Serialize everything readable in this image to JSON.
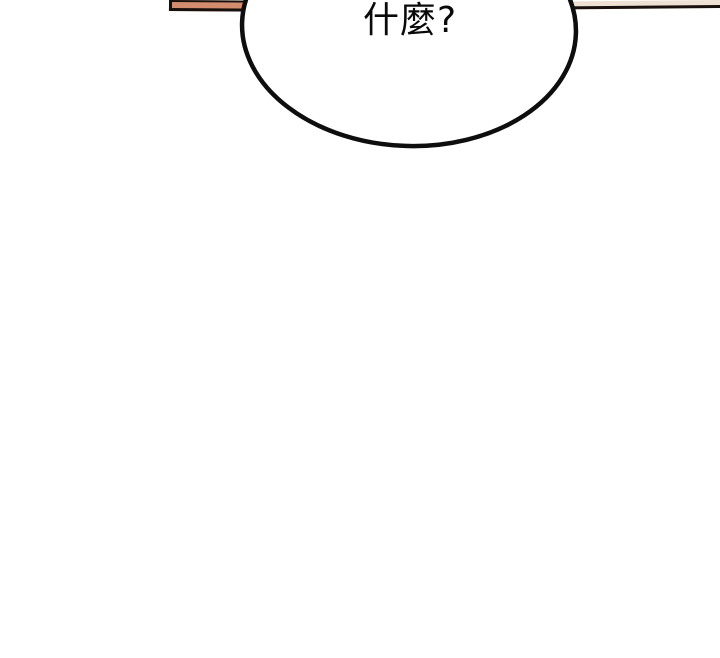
{
  "panel": {
    "background_color": "#ffffff",
    "speech_bubble": {
      "text": "什麼?",
      "fill_color": "#ffffff",
      "outline_color": "#0e0e0e"
    },
    "top_border": {
      "left_segment": {
        "fill_color": "#d28c6e",
        "edge_color": "#17100d"
      },
      "right_segment": {
        "fill_color": "#ece1d2",
        "edge_color": "#17100d"
      }
    }
  }
}
